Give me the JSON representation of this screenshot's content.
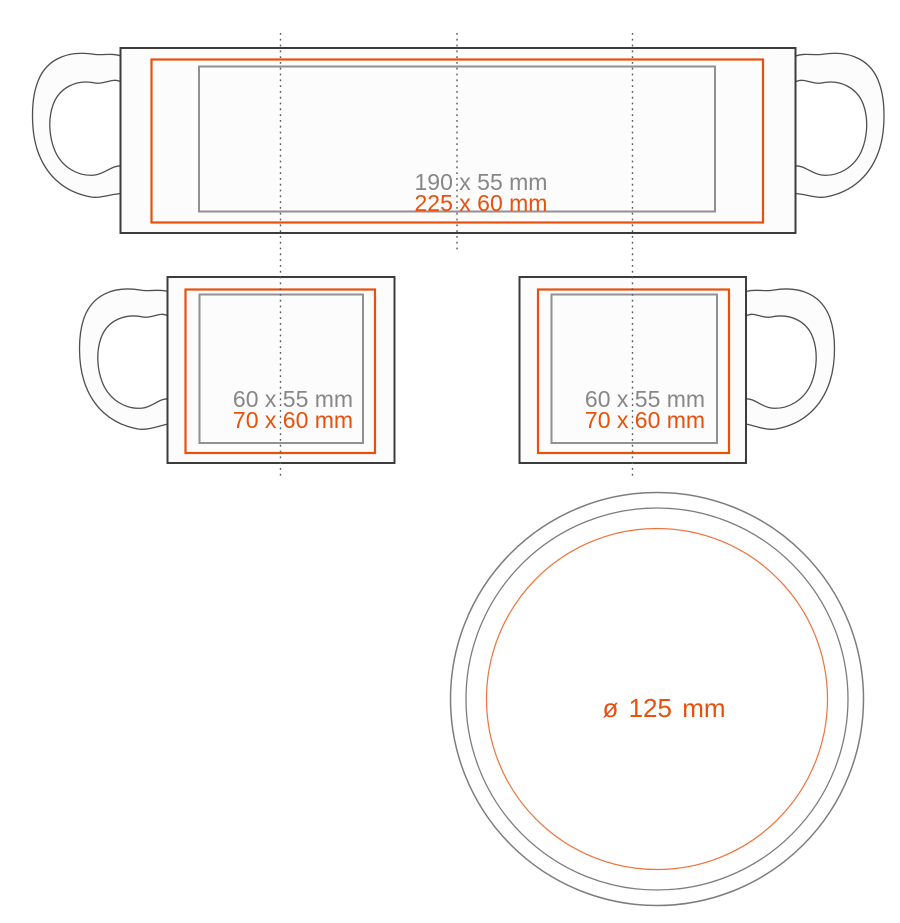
{
  "view": {
    "wrap": {
      "print_area": "190 x 55 mm",
      "max_area": "225 x 60 mm"
    },
    "side_left": {
      "print_area": "60 x 55 mm",
      "max_area": "70 x 60 mm"
    },
    "side_right": {
      "print_area": "60 x 55 mm",
      "max_area": "70 x 60 mm"
    },
    "bottom": {
      "diameter": "ø 125 mm"
    }
  },
  "colors": {
    "orange": "#E8500C",
    "gray_text": "#878787",
    "body_outline": "#3C3C3C",
    "print_frame_gray": "#919191",
    "dotted_line": "#5A5A5A",
    "circle_gray": "#7D7D7D"
  }
}
